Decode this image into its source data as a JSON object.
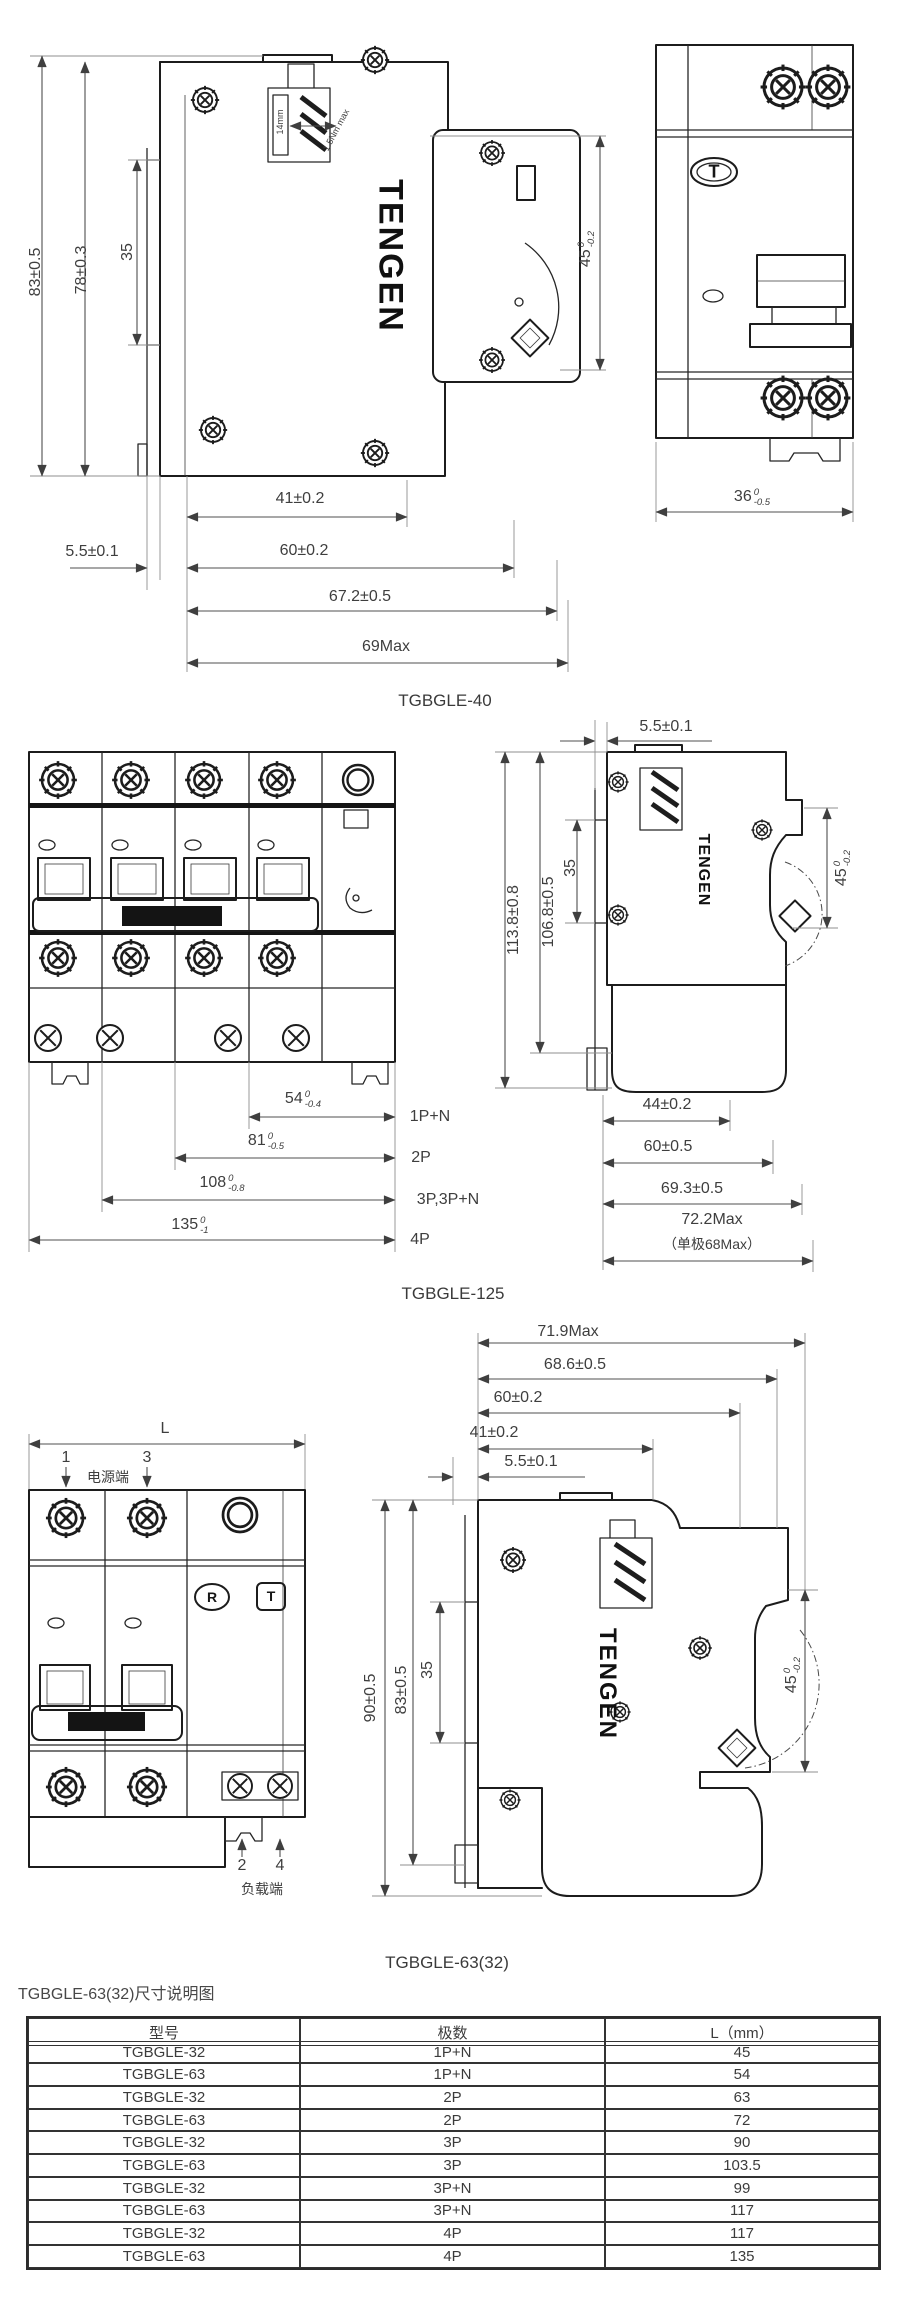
{
  "brand": {
    "logo": "TENGEN"
  },
  "fig1": {
    "label": "TGBGLE-40",
    "side": {
      "dim_h83": "83±0.5",
      "dim_h78": "78±0.3",
      "dim_h35": "35",
      "dim_d45": {
        "value": "45",
        "sup": "0",
        "sub": "-0.2"
      },
      "terminal_note": "14mm",
      "torque_note": "1.5Nm max",
      "dim_w41": "41±0.2",
      "dim_w55": "5.5±0.1",
      "dim_w60": "60±0.2",
      "dim_w672": "67.2±0.5",
      "dim_w69": "69Max"
    },
    "front": {
      "test_button": "T",
      "dim_w36": {
        "value": "36",
        "sup": "0",
        "sub": "-0.5"
      }
    }
  },
  "fig2": {
    "label": "TGBGLE-125",
    "side": {
      "dim_w55": "5.5±0.1",
      "dim_h1138": "113.8±0.8",
      "dim_h1068": "106.8±0.5",
      "dim_h35": "35",
      "dim_d45": {
        "value": "45",
        "sup": "0",
        "sub": "-0.2"
      },
      "dim_w44": "44±0.2",
      "dim_w60": "60±0.5",
      "dim_w693": "69.3±0.5",
      "dim_w722": "72.2Max",
      "dim_w68": "（单极68Max）"
    },
    "front": {
      "width_dims": [
        {
          "value": "54",
          "sup": "0",
          "sub": "-0.4",
          "pole": "1P+N"
        },
        {
          "value": "81",
          "sup": "0",
          "sub": "-0.5",
          "pole": "2P"
        },
        {
          "value": "108",
          "sup": "0",
          "sub": "-0.8",
          "pole": "3P,3P+N"
        },
        {
          "value": "135",
          "sup": "0",
          "sub": "-1",
          "pole": "4P"
        }
      ]
    }
  },
  "fig3": {
    "label": "TGBGLE-63(32)",
    "front": {
      "dim_L": "L",
      "terminal_1": "1",
      "terminal_3": "3",
      "power_side": "电源端",
      "terminal_2": "2",
      "terminal_4": "4",
      "load_side": "负载端",
      "reset_button": "R",
      "test_button": "T"
    },
    "side": {
      "dim_w719": "71.9Max",
      "dim_w686": "68.6±0.5",
      "dim_w60": "60±0.2",
      "dim_w41": "41±0.2",
      "dim_w55": "5.5±0.1",
      "dim_h90": "90±0.5",
      "dim_h83": "83±0.5",
      "dim_h35": "35",
      "dim_d45": {
        "value": "45",
        "sup": "0",
        "sub": "-0.2"
      }
    }
  },
  "table_section": {
    "heading": "TGBGLE-63(32)尺寸说明图",
    "headers": [
      "型号",
      "极数",
      "L（mm）"
    ],
    "rows": [
      [
        "TGBGLE-32",
        "1P+N",
        "45"
      ],
      [
        "TGBGLE-63",
        "1P+N",
        "54"
      ],
      [
        "TGBGLE-32",
        "2P",
        "63"
      ],
      [
        "TGBGLE-63",
        "2P",
        "72"
      ],
      [
        "TGBGLE-32",
        "3P",
        "90"
      ],
      [
        "TGBGLE-63",
        "3P",
        "103.5"
      ],
      [
        "TGBGLE-32",
        "3P+N",
        "99"
      ],
      [
        "TGBGLE-63",
        "3P+N",
        "117"
      ],
      [
        "TGBGLE-32",
        "4P",
        "117"
      ],
      [
        "TGBGLE-63",
        "4P",
        "135"
      ]
    ]
  }
}
